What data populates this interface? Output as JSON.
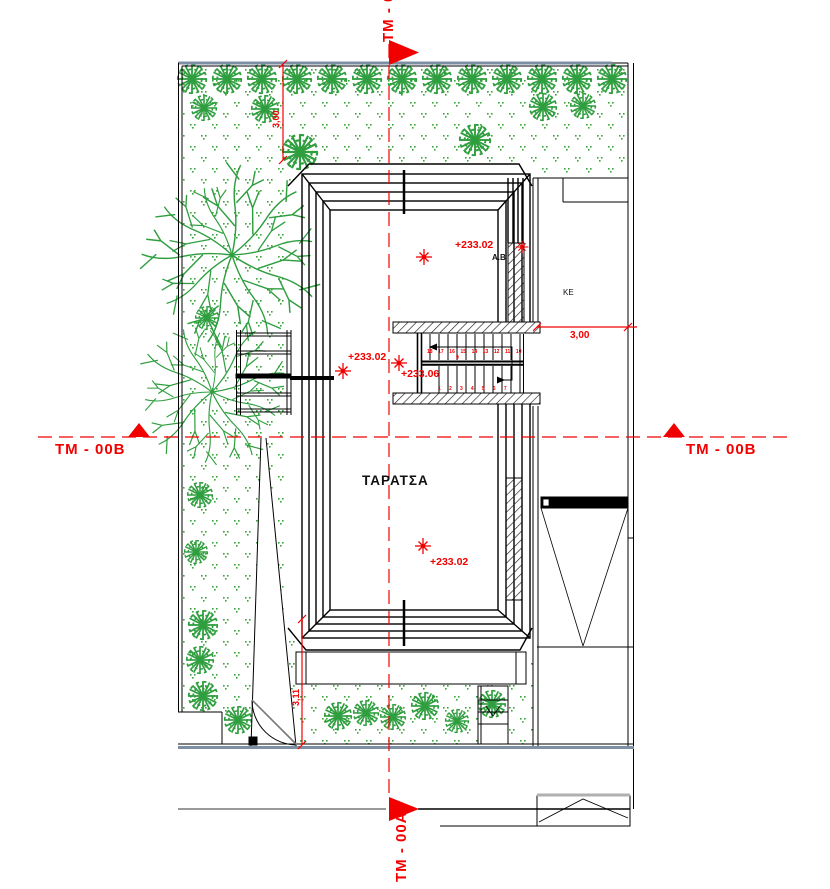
{
  "plan": {
    "axes": {
      "top": "TM - 00A",
      "bottom": "TM - 00A",
      "left": "TM - 00B",
      "right": "TM - 00B"
    },
    "labels": {
      "roof": "ΤΑΡΑΤΣΑ",
      "room": "KE",
      "point": "A.B"
    },
    "levels": {
      "top": "+233.02",
      "stair_left": "+233.02",
      "stair_entry": "+233.06",
      "bottom": "+233.02"
    },
    "dimensions": {
      "right": "3,00",
      "top_left": "3,00",
      "bottom_left": "3,11"
    },
    "stairs": {
      "upper": "18 17 16 15 14 13 12 11 10",
      "mid": "9",
      "lower": "1 2 3 4 5 6 7"
    },
    "colors": {
      "annotation": "#f20000",
      "vegetation": "#2f9e3f",
      "boundary": "#7d8fa3",
      "line": "#000000"
    }
  }
}
